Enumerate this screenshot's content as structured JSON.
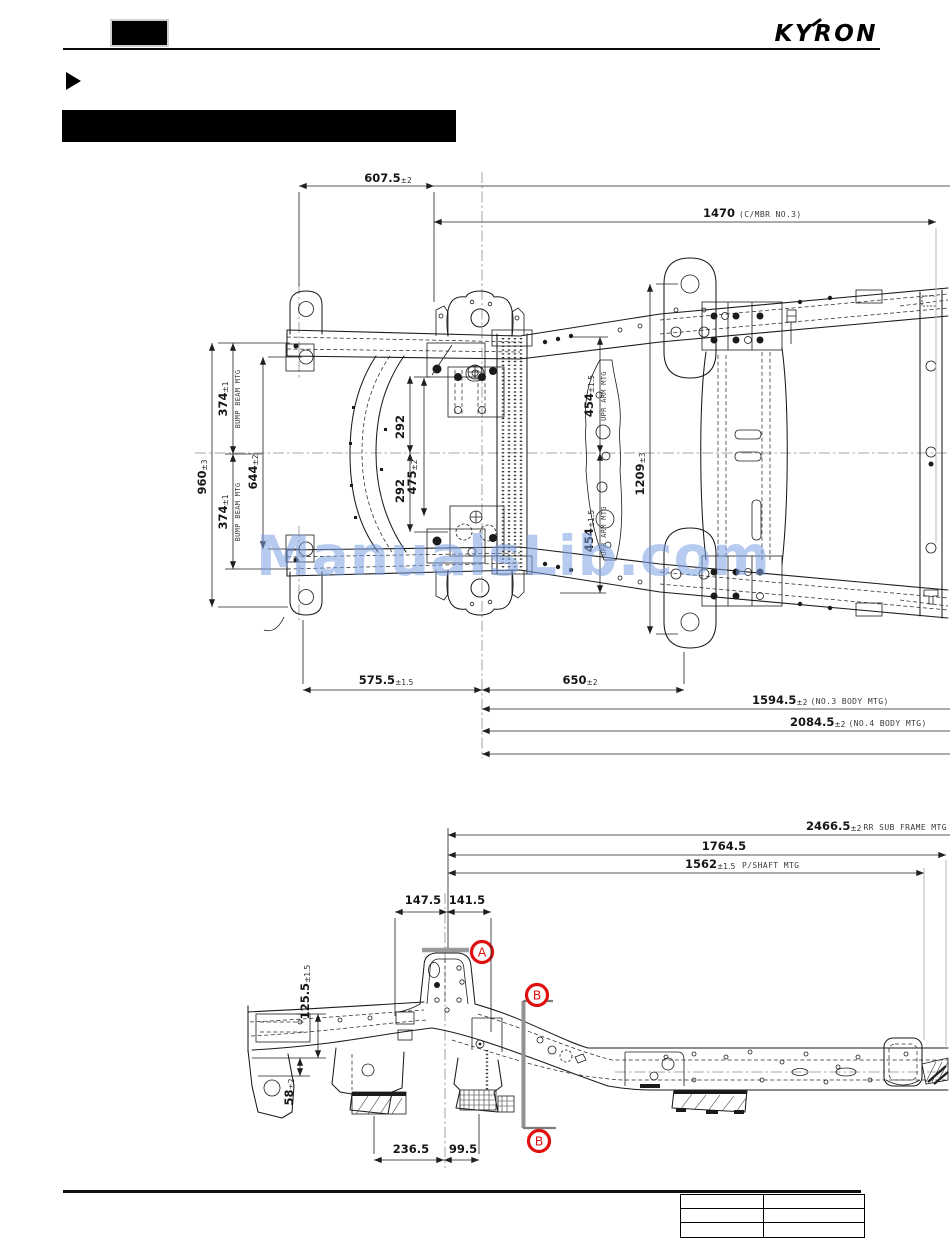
{
  "header": {
    "logo_text": "KYRON"
  },
  "watermark": {
    "text": "ManualsLib.com",
    "color": "#9fc0ee"
  },
  "drawing_top": {
    "dims": {
      "w607": {
        "v": "607.5",
        "t": "±2"
      },
      "w1470": {
        "v": "1470",
        "n": "(C/MBR NO.3)"
      },
      "h374t": {
        "v": "374",
        "t": "±1",
        "n": "BUMP BEAM MTG"
      },
      "h960": {
        "v": "960",
        "t": "±3"
      },
      "h644": {
        "v": "644",
        "t": "±2"
      },
      "h374b": {
        "v": "374",
        "t": "±1",
        "n": "BUMP BEAM MTG"
      },
      "h292t": {
        "v": "292"
      },
      "h292b": {
        "v": "292"
      },
      "h475": {
        "v": "475",
        "t": "±2"
      },
      "h454t": {
        "v": "454",
        "t": "±1.5",
        "n": "UPR ARM MTG"
      },
      "h1209": {
        "v": "1209",
        "t": "±3"
      },
      "h454b": {
        "v": "454",
        "t": "±1.5",
        "n": "UPR ARM MTG"
      },
      "w575": {
        "v": "575.5",
        "t": "±1.5"
      },
      "w650": {
        "v": "650",
        "t": "±2"
      },
      "w1594": {
        "v": "1594.5",
        "t": "±2",
        "n": "(NO.3 BODY MTG)"
      },
      "w2084": {
        "v": "2084.5",
        "t": "±2",
        "n": "(NO.4 BODY MTG)"
      }
    }
  },
  "drawing_side": {
    "dims": {
      "w2466": {
        "v": "2466.5",
        "t": "±2",
        "n": "RR SUB FRAME MTG"
      },
      "w1764": {
        "v": "1764.5"
      },
      "w1562": {
        "v": "1562",
        "t": "±1.5",
        "n": "P/SHAFT MTG"
      },
      "w147": {
        "v": "147.5"
      },
      "w141": {
        "v": "141.5"
      },
      "h125": {
        "v": "125.5",
        "t": "±1.5"
      },
      "h58": {
        "v": "58",
        "t": "±2"
      },
      "w236": {
        "v": "236.5"
      },
      "w99": {
        "v": "99.5"
      }
    },
    "markers": {
      "a": "A",
      "b_top": "B",
      "b_bottom": "B",
      "color": "#e01010"
    }
  },
  "footer": {
    "table_rows": 3,
    "table_cols": 2
  }
}
